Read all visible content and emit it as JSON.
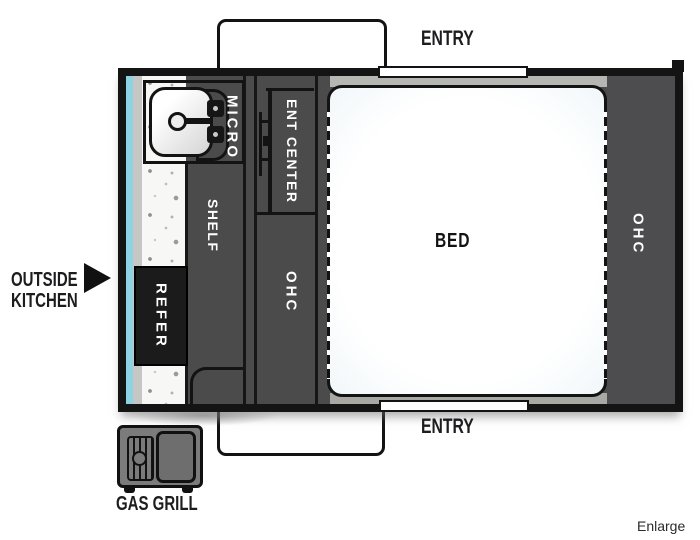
{
  "floorplan": {
    "rooms": {
      "bed": "BED",
      "micro": "MICRO",
      "ent_center": "ENT CENTER",
      "shelf": "SHELF",
      "refer": "REFER",
      "ohc_left": "OHC",
      "ohc_right": "OHC"
    },
    "doors": {
      "entry_top": "ENTRY",
      "entry_bottom": "ENTRY"
    },
    "exterior": {
      "outside_kitchen_line1": "OUTSIDE",
      "outside_kitchen_line2": "KITCHEN",
      "gas_grill": "GAS GRILL"
    },
    "actions": {
      "enlarge": "Enlarge"
    },
    "colors": {
      "wall": "#141414",
      "cabinet_gray": "#4b4b4c",
      "accent_trim_cyan": "#8ed3e3",
      "counter_speckle": "#f7f7f6",
      "bed_tint": "#d5e6ef",
      "refer_block": "#1b1b1b",
      "label_on_dark": "#ffffff",
      "label_on_light": "#1d1d1f"
    }
  }
}
